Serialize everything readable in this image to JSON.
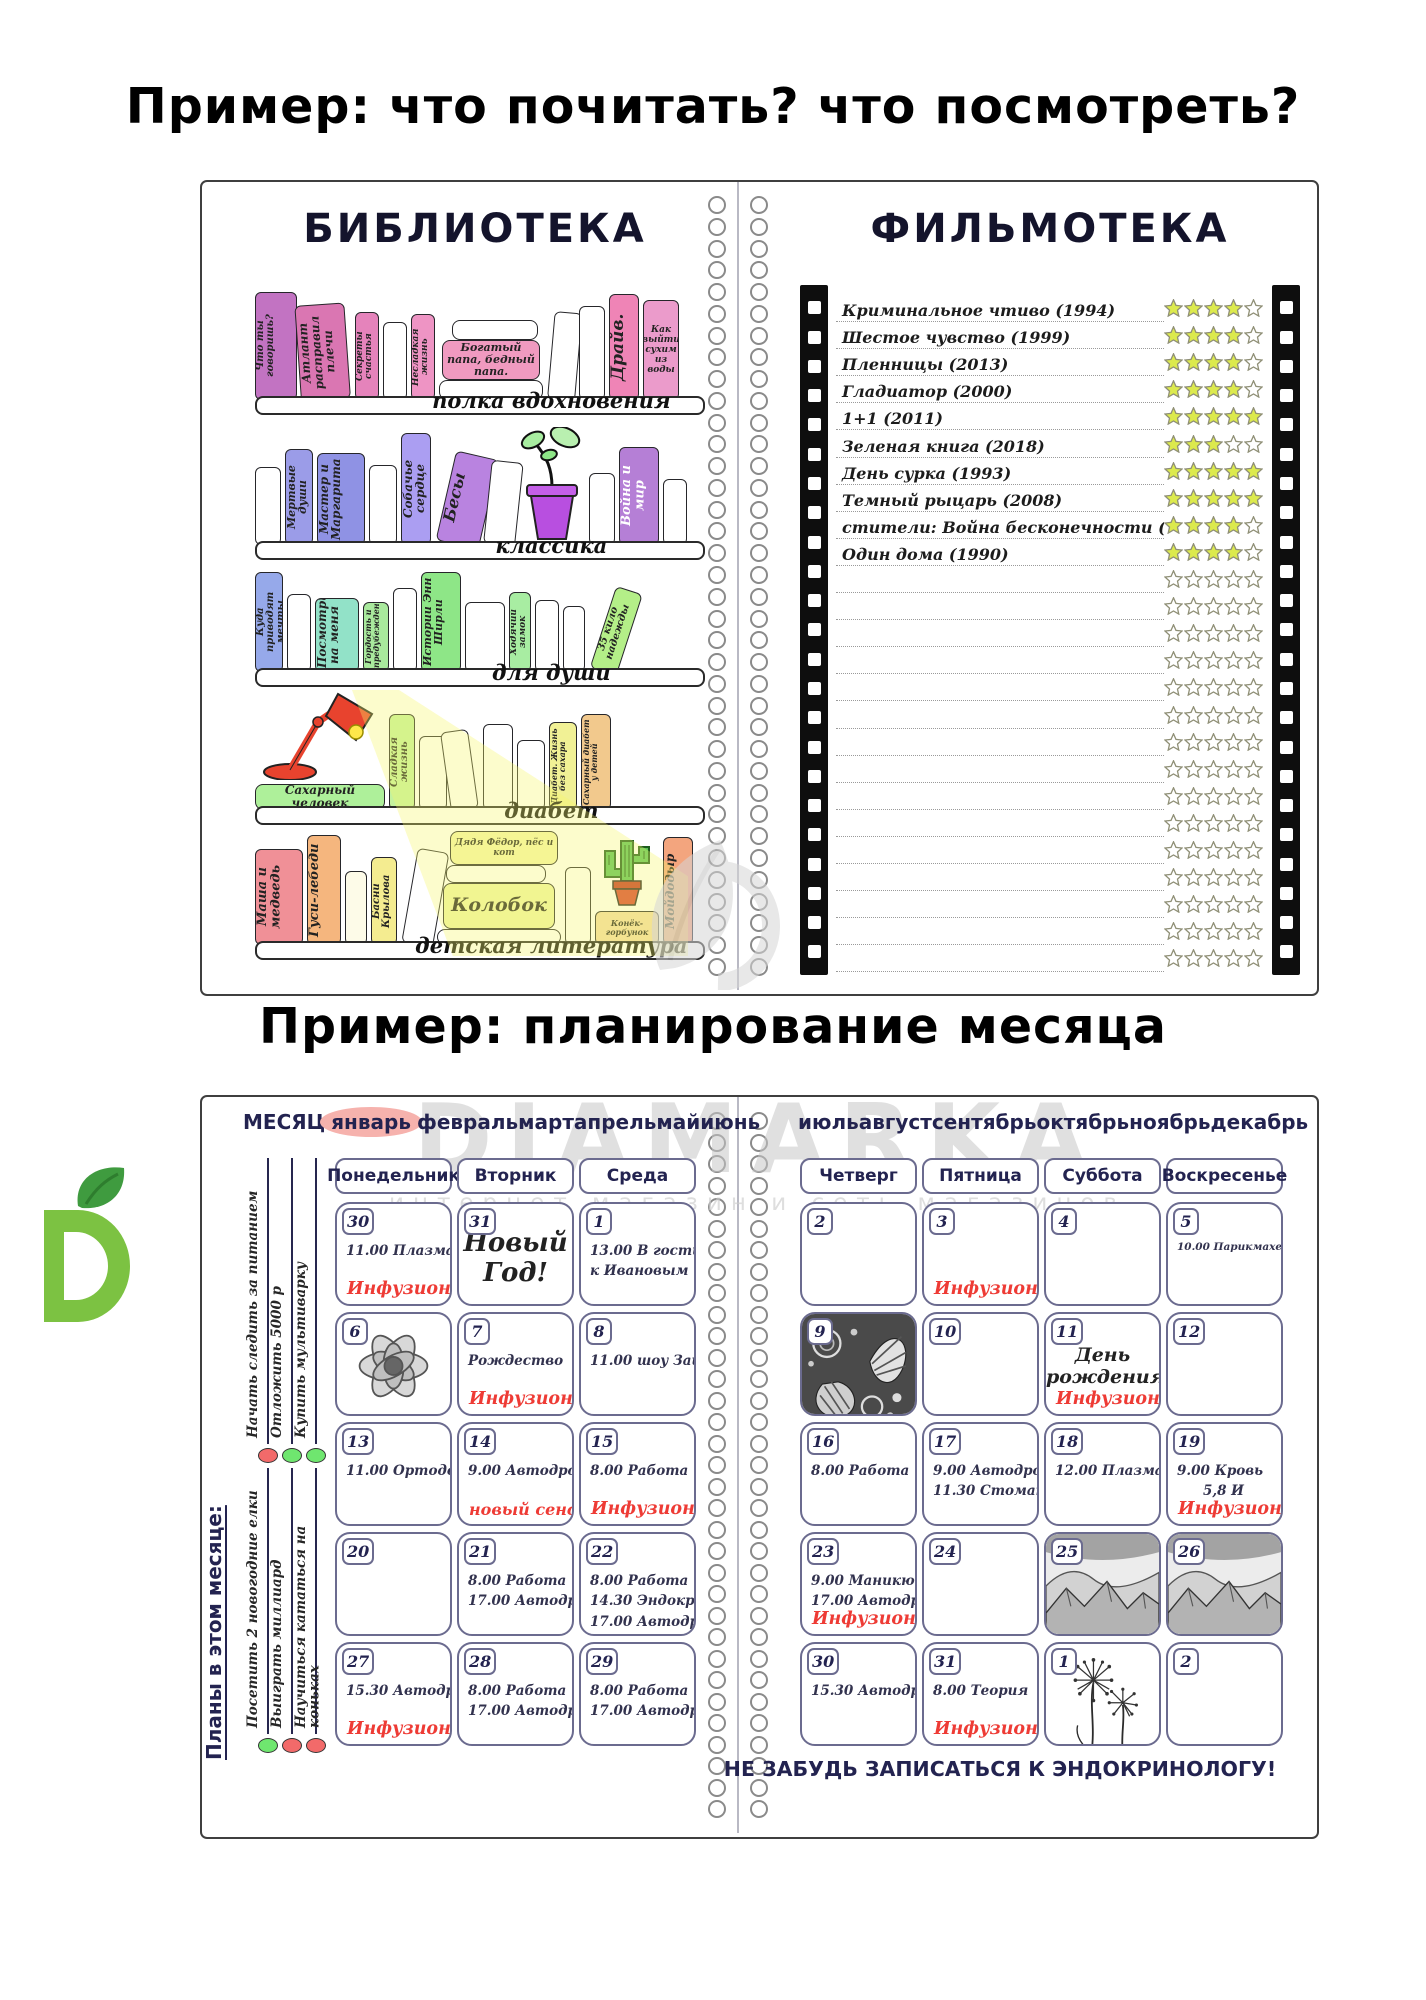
{
  "page": {
    "title_top": "Пример: что почитать? что посмотреть?",
    "title_middle": "Пример: планирование месяца",
    "watermark": {
      "brand": "DIAMARKA",
      "subtitle": "интернет магазин и сеть магазинов"
    }
  },
  "colors": {
    "navy": "#232350",
    "accent_red": "#ee3b35",
    "cell_border": "#6b6b8f",
    "star_filled": "#dcea4d",
    "star_empty": "#ffffff",
    "star_stroke": "#8f8f76",
    "month_highlight": "#f6b2ad",
    "watermark_gray": "#c7c7c7",
    "logo_green": "#7cc242"
  },
  "library": {
    "title": "БИБЛИОТЕКА",
    "shelves": [
      {
        "label": "полка вдохновения",
        "books": [
          {
            "t": "v",
            "label": "Что ты говоришь?",
            "c": "#c273c2",
            "w": 42,
            "h": 108,
            "fs": 10
          },
          {
            "t": "v",
            "label": "Атлант расправил плечи",
            "c": "#da76b2",
            "w": 50,
            "h": 96,
            "fs": 12,
            "tilt": -4
          },
          {
            "t": "v",
            "label": "Секреты счастья",
            "c": "#e583bb",
            "w": 24,
            "h": 88,
            "fs": 9
          },
          {
            "t": "v",
            "label": "",
            "c": "#ffffff",
            "w": 24,
            "h": 78
          },
          {
            "t": "v",
            "label": "Несладкая жизнь",
            "c": "#ee94c4",
            "w": 24,
            "h": 86,
            "fs": 9
          },
          {
            "t": "stack",
            "w": 104,
            "items": [
              {
                "label": "",
                "c": "#ffffff",
                "w": 86,
                "h": 20,
                "off": 8
              },
              {
                "label": "Богатый папа, бедный папа.",
                "c": "#f09ac0",
                "w": 98,
                "h": 40,
                "fs": 11
              },
              {
                "label": "",
                "c": "#ffffff",
                "w": 104,
                "h": 20,
                "off": 0
              }
            ]
          },
          {
            "t": "v",
            "label": "",
            "c": "#ffffff",
            "w": 28,
            "h": 88,
            "tilt": 5
          },
          {
            "t": "v",
            "label": "",
            "c": "#ffffff",
            "w": 26,
            "h": 94
          },
          {
            "t": "v",
            "label": "Драйв.",
            "c": "#ef84b6",
            "w": 30,
            "h": 106,
            "fs": 17
          },
          {
            "t": "v",
            "label": "Как выйти сухим из воды",
            "c": "#eb9bcb",
            "w": 36,
            "h": 100,
            "fs": 9,
            "multi": true
          }
        ]
      },
      {
        "label": "классика",
        "books": [
          {
            "t": "v",
            "label": "",
            "c": "#ffffff",
            "w": 26,
            "h": 78
          },
          {
            "t": "v",
            "label": "Мертвые души",
            "c": "#9b9ce8",
            "w": 28,
            "h": 96,
            "fs": 11
          },
          {
            "t": "v",
            "label": "Мастер и Маргарита",
            "c": "#8f92e4",
            "w": 48,
            "h": 92,
            "fs": 12
          },
          {
            "t": "v",
            "label": "",
            "c": "#ffffff",
            "w": 28,
            "h": 80
          },
          {
            "t": "v",
            "label": "Собачье сердце",
            "c": "#ab9ef2",
            "w": 30,
            "h": 112,
            "fs": 12
          },
          {
            "t": "v",
            "label": "Бесы",
            "c": "#b983e0",
            "w": 44,
            "h": 92,
            "fs": 16,
            "tilt": 13
          },
          {
            "t": "v",
            "label": "",
            "c": "#ffffff",
            "w": 32,
            "h": 84,
            "tilt": 6
          },
          {
            "t": "plant",
            "w": 66
          },
          {
            "t": "v",
            "label": "",
            "c": "#ffffff",
            "w": 26,
            "h": 72
          },
          {
            "t": "v",
            "label": "Война и мир",
            "c": "#b57fd6",
            "w": 40,
            "h": 98,
            "fs": 13,
            "tc": "#ffffff"
          },
          {
            "t": "v",
            "label": "",
            "c": "#ffffff",
            "w": 24,
            "h": 66
          }
        ]
      },
      {
        "label": "для души",
        "books": [
          {
            "t": "v",
            "label": "Куда приводят мечты",
            "c": "#96a9ea",
            "w": 28,
            "h": 100,
            "fs": 10
          },
          {
            "t": "v",
            "label": "",
            "c": "#ffffff",
            "w": 24,
            "h": 78
          },
          {
            "t": "v",
            "label": "Посмотри на меня",
            "c": "#92e2c8",
            "w": 44,
            "h": 74,
            "fs": 12
          },
          {
            "t": "v",
            "label": "Гордость и предубеждение",
            "c": "#a9e99d",
            "w": 26,
            "h": 70,
            "fs": 8
          },
          {
            "t": "v",
            "label": "",
            "c": "#ffffff",
            "w": 24,
            "h": 84
          },
          {
            "t": "v",
            "label": "Истории Энн Ширли",
            "c": "#8ee687",
            "w": 40,
            "h": 100,
            "fs": 11
          },
          {
            "t": "v",
            "label": "",
            "c": "#ffffff",
            "w": 40,
            "h": 70
          },
          {
            "t": "v",
            "label": "Ходячий замок",
            "c": "#a8eda2",
            "w": 22,
            "h": 80,
            "fs": 9
          },
          {
            "t": "v",
            "label": "",
            "c": "#ffffff",
            "w": 24,
            "h": 72
          },
          {
            "t": "v",
            "label": "",
            "c": "#ffffff",
            "w": 22,
            "h": 66
          },
          {
            "t": "v",
            "label": "35 кило надежды",
            "c": "#b4ef88",
            "w": 28,
            "h": 86,
            "fs": 10,
            "tilt": 18
          }
        ]
      },
      {
        "label": "диабет",
        "books": [
          {
            "t": "lampstack",
            "w": 130,
            "book": {
              "label": "Сахарный человек",
              "c": "#aef09a",
              "w": 130,
              "h": 26,
              "fs": 12
            }
          },
          {
            "t": "v",
            "label": "Сладкая жизнь",
            "c": "#c4f29e",
            "w": 26,
            "h": 96,
            "fs": 10
          },
          {
            "t": "v",
            "label": "",
            "c": "#ffffff",
            "w": 28,
            "h": 74
          },
          {
            "t": "v",
            "label": "",
            "c": "#ffffff",
            "w": 28,
            "h": 80,
            "tilt": -8
          },
          {
            "t": "v",
            "label": "",
            "c": "#ffffff",
            "w": 30,
            "h": 86
          },
          {
            "t": "v",
            "label": "",
            "c": "#ffffff",
            "w": 28,
            "h": 70
          },
          {
            "t": "v",
            "label": "Диабет. Жизнь без сахара",
            "c": "#f1f195",
            "w": 28,
            "h": 88,
            "fs": 8
          },
          {
            "t": "v",
            "label": "Сахарный диабет у детей",
            "c": "#f2c98d",
            "w": 30,
            "h": 96,
            "fs": 8
          }
        ]
      },
      {
        "label": "детская литература",
        "books": [
          {
            "t": "v",
            "label": "Маша и медведь",
            "c": "#f09097",
            "w": 48,
            "h": 96,
            "fs": 13
          },
          {
            "t": "v",
            "label": "Гуси-лебеди",
            "c": "#f5b67e",
            "w": 34,
            "h": 110,
            "fs": 13
          },
          {
            "t": "v",
            "label": "",
            "c": "#fdfbe8",
            "w": 22,
            "h": 74
          },
          {
            "t": "v",
            "label": "Басни Крылова",
            "c": "#f4ec90",
            "w": 26,
            "h": 88,
            "fs": 10
          },
          {
            "t": "v",
            "label": "",
            "c": "#ffffff",
            "w": 32,
            "h": 96,
            "tilt": 10
          },
          {
            "t": "stack",
            "w": 124,
            "items": [
              {
                "label": "Дядя Фёдор, пёс и кот",
                "c": "#f5f5aa",
                "w": 108,
                "h": 34,
                "fs": 9,
                "off": 10
              },
              {
                "label": "",
                "c": "#ffffff",
                "w": 100,
                "h": 18,
                "off": -6
              },
              {
                "label": "Колобок",
                "c": "#eff5a6",
                "w": 112,
                "h": 46,
                "fs": 19
              },
              {
                "label": "",
                "c": "#ffffff",
                "w": 124,
                "h": 16,
                "off": 0
              }
            ]
          },
          {
            "t": "v",
            "label": "",
            "c": "#ffffff",
            "w": 26,
            "h": 78
          },
          {
            "t": "cactus",
            "w": 64,
            "book": {
              "label": "Конёк-горбунок",
              "c": "#f2d9a6",
              "w": 64,
              "h": 34,
              "fs": 8
            }
          },
          {
            "t": "v",
            "label": "Мойдодыр",
            "c": "#f3a57e",
            "w": 30,
            "h": 108,
            "fs": 12
          }
        ]
      }
    ]
  },
  "filmoteka": {
    "title": "ФИЛЬМОТЕКА",
    "films": [
      {
        "title": "Криминальное чтиво (1994)",
        "stars": 4
      },
      {
        "title": "Шестое чувство (1999)",
        "stars": 4
      },
      {
        "title": "Пленницы (2013)",
        "stars": 4
      },
      {
        "title": "Гладиатор (2000)",
        "stars": 4
      },
      {
        "title": "1+1 (2011)",
        "stars": 5
      },
      {
        "title": "Зеленая книга (2018)",
        "stars": 3
      },
      {
        "title": "День сурка (1993)",
        "stars": 5
      },
      {
        "title": "Темный рыцарь (2008)",
        "stars": 5
      },
      {
        "title": "стители: Война бесконечности (2018)",
        "stars": 4
      },
      {
        "title": "Один дома (1990)",
        "stars": 4
      }
    ],
    "total_rows": 25,
    "stars_per_row": 5
  },
  "planner": {
    "month_label": "МЕСЯЦ",
    "selected_month": "январь",
    "months_left": [
      "январь",
      "февраль",
      "март",
      "апрель",
      "май",
      "июнь"
    ],
    "months_right": [
      "июль",
      "август",
      "сентябрь",
      "октябрь",
      "ноябрь",
      "декабрь"
    ],
    "left_days": [
      "Понедельник",
      "Вторник",
      "Среда"
    ],
    "right_days": [
      "Четверг",
      "Пятница",
      "Суббота",
      "Воскресенье"
    ],
    "goals_title": "Планы в этом месяце:",
    "goals_top": [
      {
        "text": "Начать следить за питанием",
        "dot": "red"
      },
      {
        "text": "Отложить 5000 р",
        "dot": "green"
      },
      {
        "text": "Купить мультиварку",
        "dot": "green"
      }
    ],
    "goals_bottom": [
      {
        "text": "Посетить 2 новогодние елки",
        "dot": "green"
      },
      {
        "text": "Выиграть миллиард",
        "dot": "red"
      },
      {
        "text": "Научиться кататься на коньках",
        "dot": "red"
      }
    ],
    "left_weeks": [
      [
        {
          "day": "30",
          "lines": [
            "11.00 Плазма"
          ],
          "red": "Инфузионка"
        },
        {
          "day": "31",
          "big": "Новый\nГод!"
        },
        {
          "day": "1",
          "lines": [
            "13.00 В гости",
            "к Ивановым"
          ]
        }
      ],
      [
        {
          "day": "6",
          "image": "flower-sketch"
        },
        {
          "day": "7",
          "lines": [
            "Рождество"
          ],
          "red": "Инфузионка"
        },
        {
          "day": "8",
          "lines": [
            "11.00 шоу Зайцы"
          ]
        }
      ],
      [
        {
          "day": "13",
          "lines": [
            "11.00 Ортодонт"
          ]
        },
        {
          "day": "14",
          "lines": [
            "9.00 Автодром"
          ],
          "red": "новый сенсор"
        },
        {
          "day": "15",
          "lines": [
            "8.00 Работа"
          ],
          "red": "Инфузионка"
        }
      ],
      [
        {
          "day": "20"
        },
        {
          "day": "21",
          "lines": [
            "8.00 Работа",
            "17.00 Автодром"
          ]
        },
        {
          "day": "22",
          "lines": [
            "8.00 Работа",
            "14.30 Эндокринолог",
            "17.00 Автодром"
          ]
        }
      ],
      [
        {
          "day": "27",
          "lines": [
            "15.30 Автодром"
          ],
          "red": "Инфузионка"
        },
        {
          "day": "28",
          "lines": [
            "8.00 Работа",
            "17.00 Автодром"
          ]
        },
        {
          "day": "29",
          "lines": [
            "8.00 Работа",
            "17.00 Автодром"
          ]
        }
      ]
    ],
    "right_weeks": [
      [
        {
          "day": "2"
        },
        {
          "day": "3",
          "red": "Инфузионка"
        },
        {
          "day": "4"
        },
        {
          "day": "5",
          "lines": [
            "10.00 Парикмахерская"
          ],
          "small": true
        }
      ],
      [
        {
          "day": "9",
          "image": "doodle-pattern"
        },
        {
          "day": "10"
        },
        {
          "day": "11",
          "big": "День\nрождения!",
          "red": "Инфузионка"
        },
        {
          "day": "12"
        }
      ],
      [
        {
          "day": "16",
          "lines": [
            "8.00 Работа"
          ]
        },
        {
          "day": "17",
          "lines": [
            "9.00 Автодром",
            "11.30 Стоматолог"
          ]
        },
        {
          "day": "18",
          "lines": [
            "12.00 Плазма"
          ]
        },
        {
          "day": "19",
          "lines": [
            "9.00 Кровь",
            "5,8 И"
          ],
          "red": "Инфузионка"
        }
      ],
      [
        {
          "day": "23",
          "lines": [
            "9.00 Маникюр",
            "17.00 Автодром"
          ],
          "red": "Инфузионка"
        },
        {
          "day": "24"
        },
        {
          "day": "25",
          "image": "mountain-sketch"
        },
        {
          "day": "26",
          "image": "mountain-sketch"
        }
      ],
      [
        {
          "day": "30",
          "lines": [
            "15.30 Автодром"
          ]
        },
        {
          "day": "31",
          "lines": [
            "8.00 Теория"
          ],
          "red": "Инфузионка"
        },
        {
          "day": "1",
          "image": "dandelion-sketch"
        },
        {
          "day": "2"
        }
      ]
    ],
    "footer_note": "НЕ ЗАБУДЬ ЗАПИСАТЬСЯ К ЭНДОКРИНОЛОГУ!"
  }
}
